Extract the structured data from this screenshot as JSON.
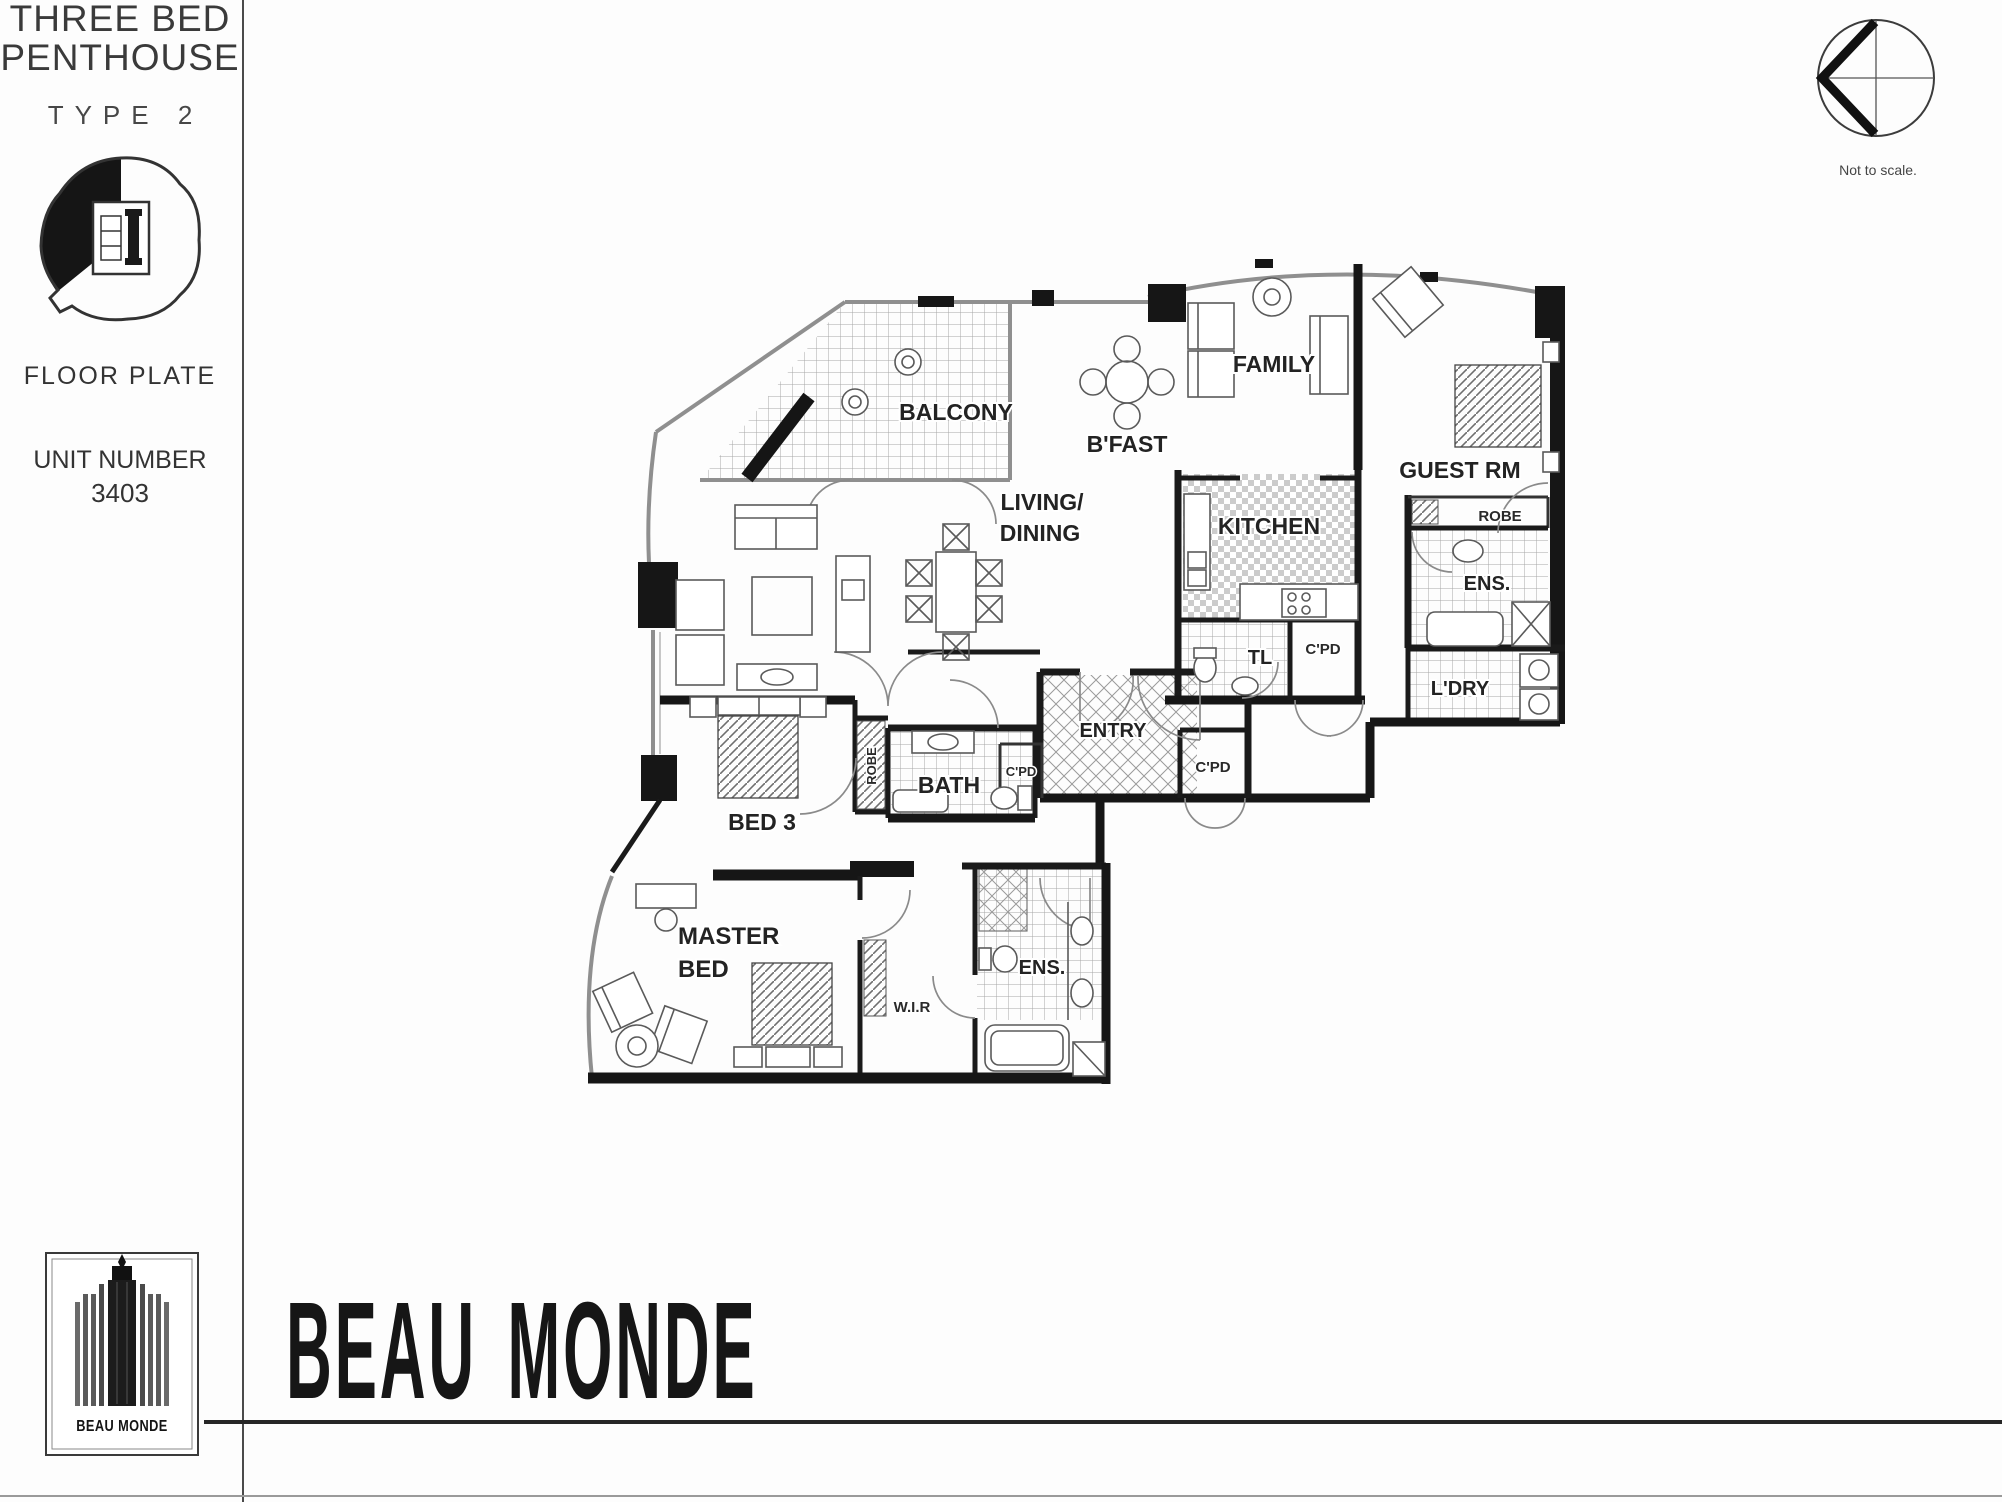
{
  "sidebar": {
    "title_line1": "THREE BED",
    "title_line2": "PENTHOUSE",
    "subtitle": "TYPE 2",
    "floor_plate_label": "FLOOR PLATE",
    "unit_label": "UNIT NUMBER",
    "unit_number": "3403",
    "logo_text": "BEAU MONDE"
  },
  "compass": {
    "note": "Not to scale."
  },
  "brand": {
    "wordmark": "BEAU MONDE"
  },
  "plan": {
    "labels": {
      "balcony": "BALCONY",
      "living_line1": "LIVING/",
      "living_line2": "DINING",
      "bfast": "B'FAST",
      "family": "FAMILY",
      "kitchen": "KITCHEN",
      "guest": "GUEST RM",
      "robe_guest": "ROBE",
      "ens_guest": "ENS.",
      "ldry": "L'DRY",
      "tl": "TL",
      "cpd_kitchen": "C'PD",
      "entry": "ENTRY",
      "cpd_entry": "C'PD",
      "cpd_hall": "C'PD",
      "bath": "BATH",
      "robe_bed3": "ROBE",
      "bed3": "BED 3",
      "master_line1": "MASTER",
      "master_line2": "BED",
      "wir": "W.I.R",
      "ens_master": "ENS."
    }
  }
}
